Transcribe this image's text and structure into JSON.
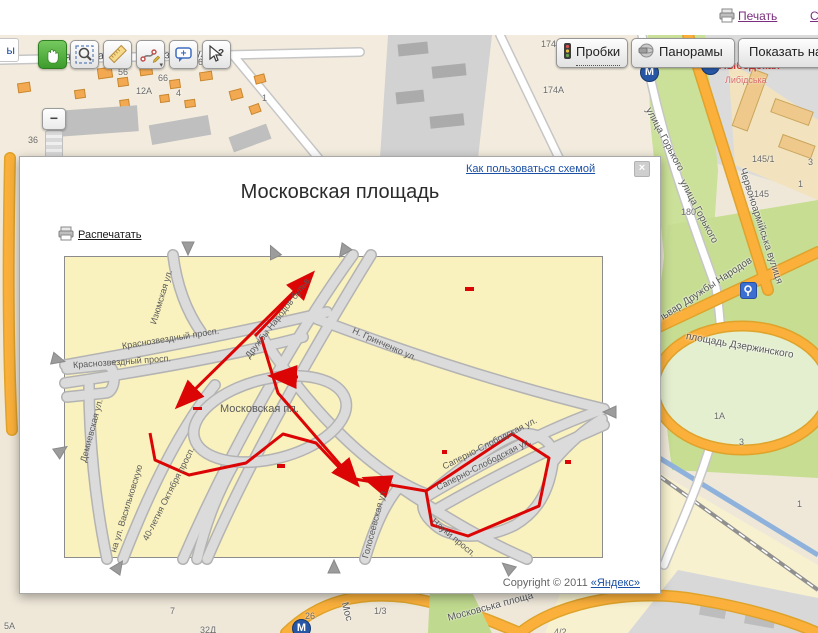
{
  "topbar": {
    "print_label": "Печать",
    "partial_link": "С"
  },
  "left_tab": "ы",
  "zoom": {
    "minus": "−",
    "level": "36"
  },
  "map_buttons": {
    "traffic": "Пробки",
    "panoramas": "Панорамы",
    "show_on": "Показать на"
  },
  "dialog": {
    "help_link": "Как пользоваться схемой",
    "close": "×",
    "title": "Московская площадь",
    "print_label": "Распечатать",
    "copyright_prefix": "Copyright © 2011 ",
    "copyright_link": "«Яндекс»"
  },
  "colors": {
    "route_red": "#DC0505",
    "link_blue": "#1C50A5",
    "visited_purple": "#7B2E7E",
    "scheme_bg": "#F9F1BE",
    "metro_blue": "#2757A4",
    "metro_label_red": "#D43B3B"
  },
  "scheme": {
    "street_labels": [
      {
        "t": "Изюмская ул.",
        "x": 88,
        "y": 62,
        "r": -73,
        "s": 9
      },
      {
        "t": "Краснозвездный просп.",
        "x": 57,
        "y": 84,
        "r": -9,
        "s": 9
      },
      {
        "t": "Краснозвездный просп.",
        "x": 8,
        "y": 103,
        "r": -4,
        "s": 9
      },
      {
        "t": "Дружбы Народов бульв.",
        "x": 182,
        "y": 95,
        "r": -52,
        "s": 9
      },
      {
        "t": "Н. Гринченко ул.",
        "x": 288,
        "y": 68,
        "r": 24,
        "s": 9
      },
      {
        "t": "Московская пл.",
        "x": 155,
        "y": 146,
        "r": 0,
        "s": 11
      },
      {
        "t": "Демиевская ул.",
        "x": 18,
        "y": 200,
        "r": -75,
        "s": 9
      },
      {
        "t": "на ул. Васильковскую",
        "x": 48,
        "y": 290,
        "r": -73,
        "s": 9
      },
      {
        "t": "40-летия Октября просп.",
        "x": 80,
        "y": 278,
        "r": -63,
        "s": 9
      },
      {
        "t": "Голосеевская ул.",
        "x": 300,
        "y": 296,
        "r": -75,
        "s": 9
      },
      {
        "t": "Науки просп.",
        "x": 368,
        "y": 258,
        "r": 40,
        "s": 9
      },
      {
        "t": "Саперно-Слободская ул.",
        "x": 378,
        "y": 205,
        "r": -27,
        "s": 9
      },
      {
        "t": "Саперно-Слободская ул.",
        "x": 372,
        "y": 226,
        "r": -27,
        "s": 9
      }
    ],
    "routes": [
      {
        "points": "247,17 114,148",
        "arrow": true
      },
      {
        "points": "190,79 211,57 246,18",
        "arrow": true
      },
      {
        "points": "196,80 213,136 291,226",
        "arrow": true
      },
      {
        "points": "233,120 208,119",
        "arrow": true
      },
      {
        "points": "320,228 302,222",
        "arrow": true
      },
      {
        "points": "85,176 90,203 124,218 181,206 218,177 251,186 284,221 361,234",
        "arrow": false
      },
      {
        "points": "361,234 447,177 484,201 474,249 403,279 367,268 361,234",
        "arrow": false
      }
    ],
    "marks": [
      [
        400,
        30,
        9,
        4
      ],
      [
        212,
        207,
        8,
        4
      ],
      [
        377,
        193,
        5,
        4
      ],
      [
        500,
        203,
        6,
        4
      ],
      [
        128,
        150,
        9,
        3
      ]
    ],
    "border_arrows": [
      {
        "x": 115,
        "y": -15,
        "r": 90
      },
      {
        "x": 200,
        "y": -13,
        "r": -115
      },
      {
        "x": 270,
        "y": -12,
        "r": 125
      },
      {
        "x": -14,
        "y": 96,
        "r": 15
      },
      {
        "x": -11,
        "y": 186,
        "r": -35
      },
      {
        "x": 536,
        "y": 148,
        "r": 180
      },
      {
        "x": 46,
        "y": 302,
        "r": -55
      },
      {
        "x": 261,
        "y": 302,
        "r": -90
      },
      {
        "x": 434,
        "y": 303,
        "r": -140
      }
    ]
  },
  "base_map": {
    "labels": [
      {
        "t": "ская улица",
        "x": 48,
        "y": 17,
        "r": -2,
        "s": 11
      },
      {
        "t": "Волзька вулиця",
        "x": 145,
        "y": 15,
        "r": -2,
        "s": 11
      },
      {
        "t": "улица Горького",
        "x": 648,
        "y": 68,
        "r": 62,
        "s": 10
      },
      {
        "t": "улица Горького",
        "x": 682,
        "y": 140,
        "r": 62,
        "s": 10
      },
      {
        "t": "Червоноармійська вулиця",
        "x": 742,
        "y": 128,
        "r": 72,
        "s": 10
      },
      {
        "t": "бульвар Дружбы Народов",
        "x": 650,
        "y": 285,
        "r": -33,
        "s": 10
      },
      {
        "t": "площадь Дзержинского",
        "x": 686,
        "y": 296,
        "r": 10,
        "s": 10
      },
      {
        "t": "Московська площа",
        "x": 448,
        "y": 578,
        "r": -15,
        "s": 10
      },
      {
        "t": "Мос",
        "x": 344,
        "y": 562,
        "r": 75,
        "s": 10
      }
    ],
    "numbers": [
      [
        "56",
        118,
        32
      ],
      [
        "66",
        158,
        38
      ],
      [
        "12А",
        136,
        51
      ],
      [
        "4",
        176,
        53
      ],
      [
        "69/2",
        198,
        22
      ],
      [
        "1",
        262,
        58
      ],
      [
        "174",
        541,
        4
      ],
      [
        "174А",
        543,
        50
      ],
      [
        "145/1",
        752,
        119
      ],
      [
        "3",
        808,
        122
      ],
      [
        "1",
        798,
        144
      ],
      [
        "145",
        754,
        154
      ],
      [
        "180",
        681,
        172
      ],
      [
        "1А",
        714,
        376
      ],
      [
        "3",
        739,
        402
      ],
      [
        "1",
        797,
        464
      ],
      [
        "5А",
        4,
        586
      ],
      [
        "7",
        170,
        571
      ],
      [
        "26",
        305,
        576
      ],
      [
        "32Д",
        200,
        590
      ],
      [
        "1/3",
        374,
        571
      ],
      [
        "4/2",
        554,
        592
      ]
    ],
    "metro_stations": [
      {
        "x": 640,
        "y": 28,
        "g": "М"
      },
      {
        "x": 701,
        "y": 21,
        "g": "М",
        "label": "Лыбедская",
        "label2": "Либідська",
        "lx": 719,
        "ly": 25,
        "l2x": 725,
        "l2y": 40
      },
      {
        "x": 292,
        "y": 584,
        "g": "М"
      }
    ],
    "poi": {
      "x": 740,
      "y": 247
    }
  }
}
